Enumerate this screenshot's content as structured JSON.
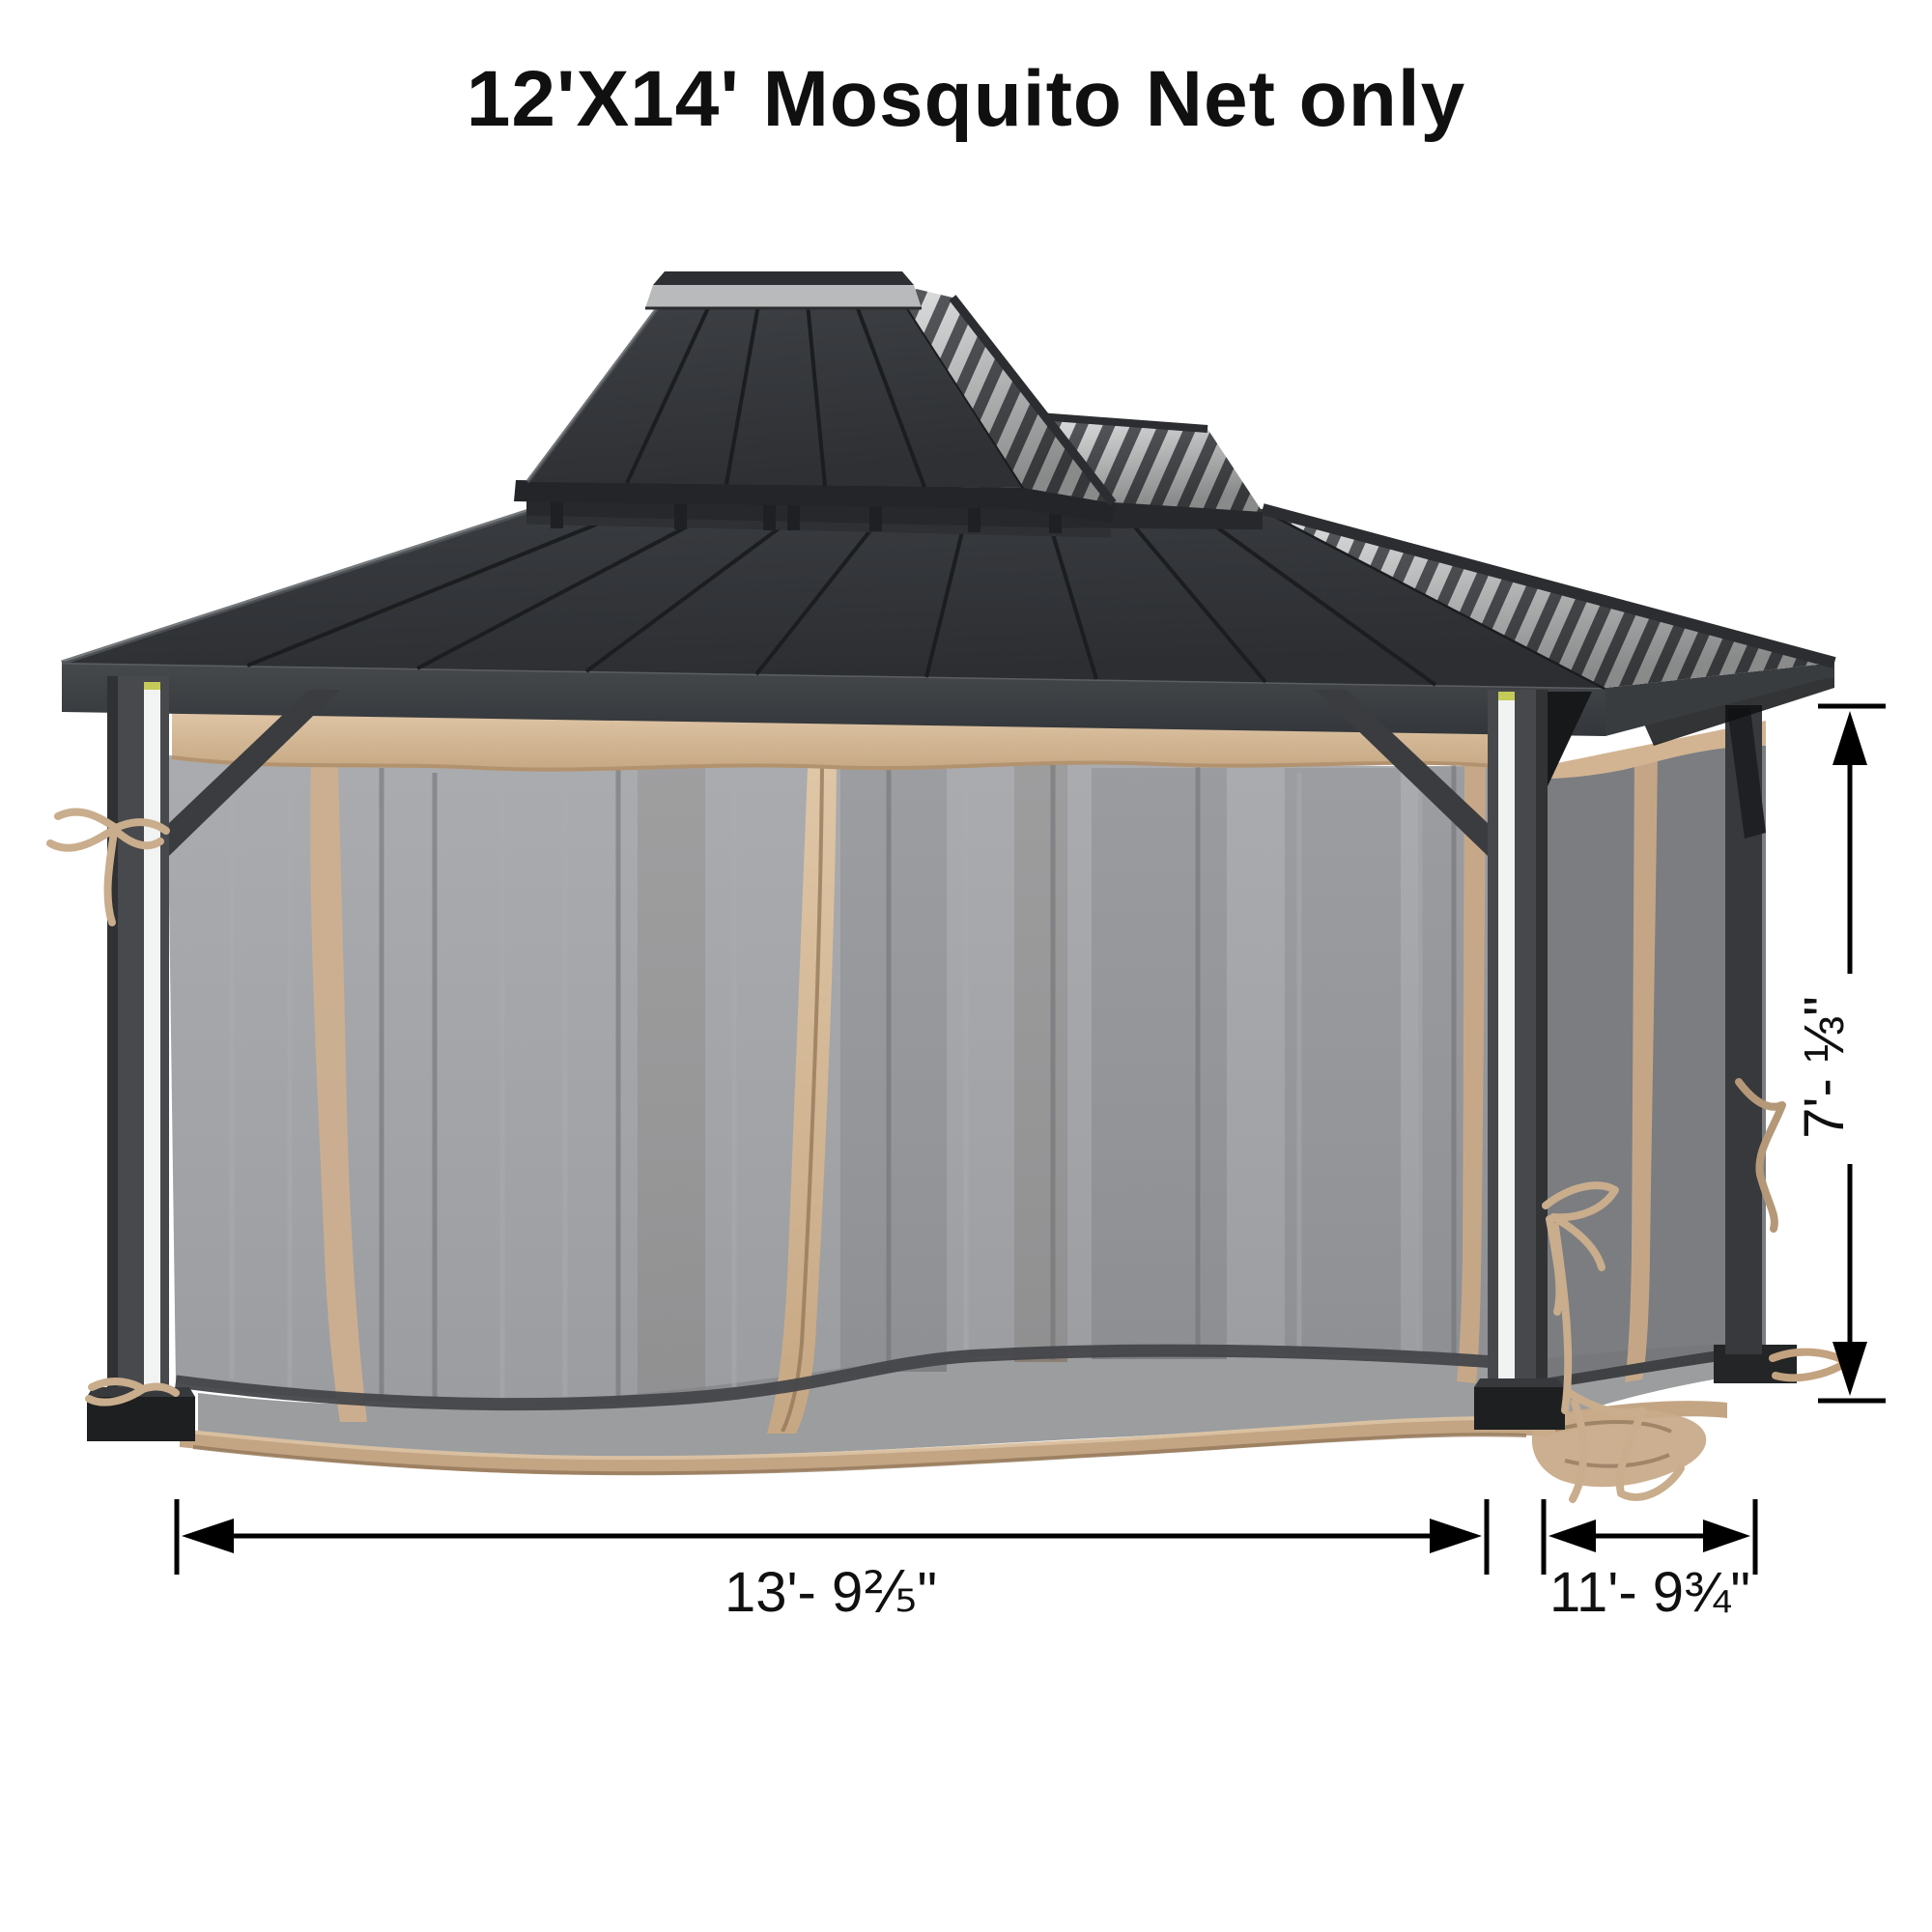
{
  "title": "12'X14' Mosquito Net only",
  "dimensions": {
    "front_width_label": "13'- 9⅖\"",
    "side_depth_label": "11'- 9¾\"",
    "net_height_label": "7'- ⅓\""
  },
  "illustration": {
    "subject": "double-tier hardtop gazebo with gray mosquito netting and tan trim",
    "colors": {
      "background": "#ffffff",
      "roof_panel": "#323539",
      "roof_seam": "#1b1d1f",
      "roof_rib_light": "#ecedee",
      "roof_rib_dark": "#5c5f63",
      "frame": "#47494c",
      "mesh_net": "#8e9094",
      "mesh_net_side": "#74767a",
      "trim_tan": "#c9ab8a",
      "trim_tan_light": "#dcc2a2",
      "floor": "#9b9d9f",
      "dimension_ink": "#000000"
    }
  }
}
